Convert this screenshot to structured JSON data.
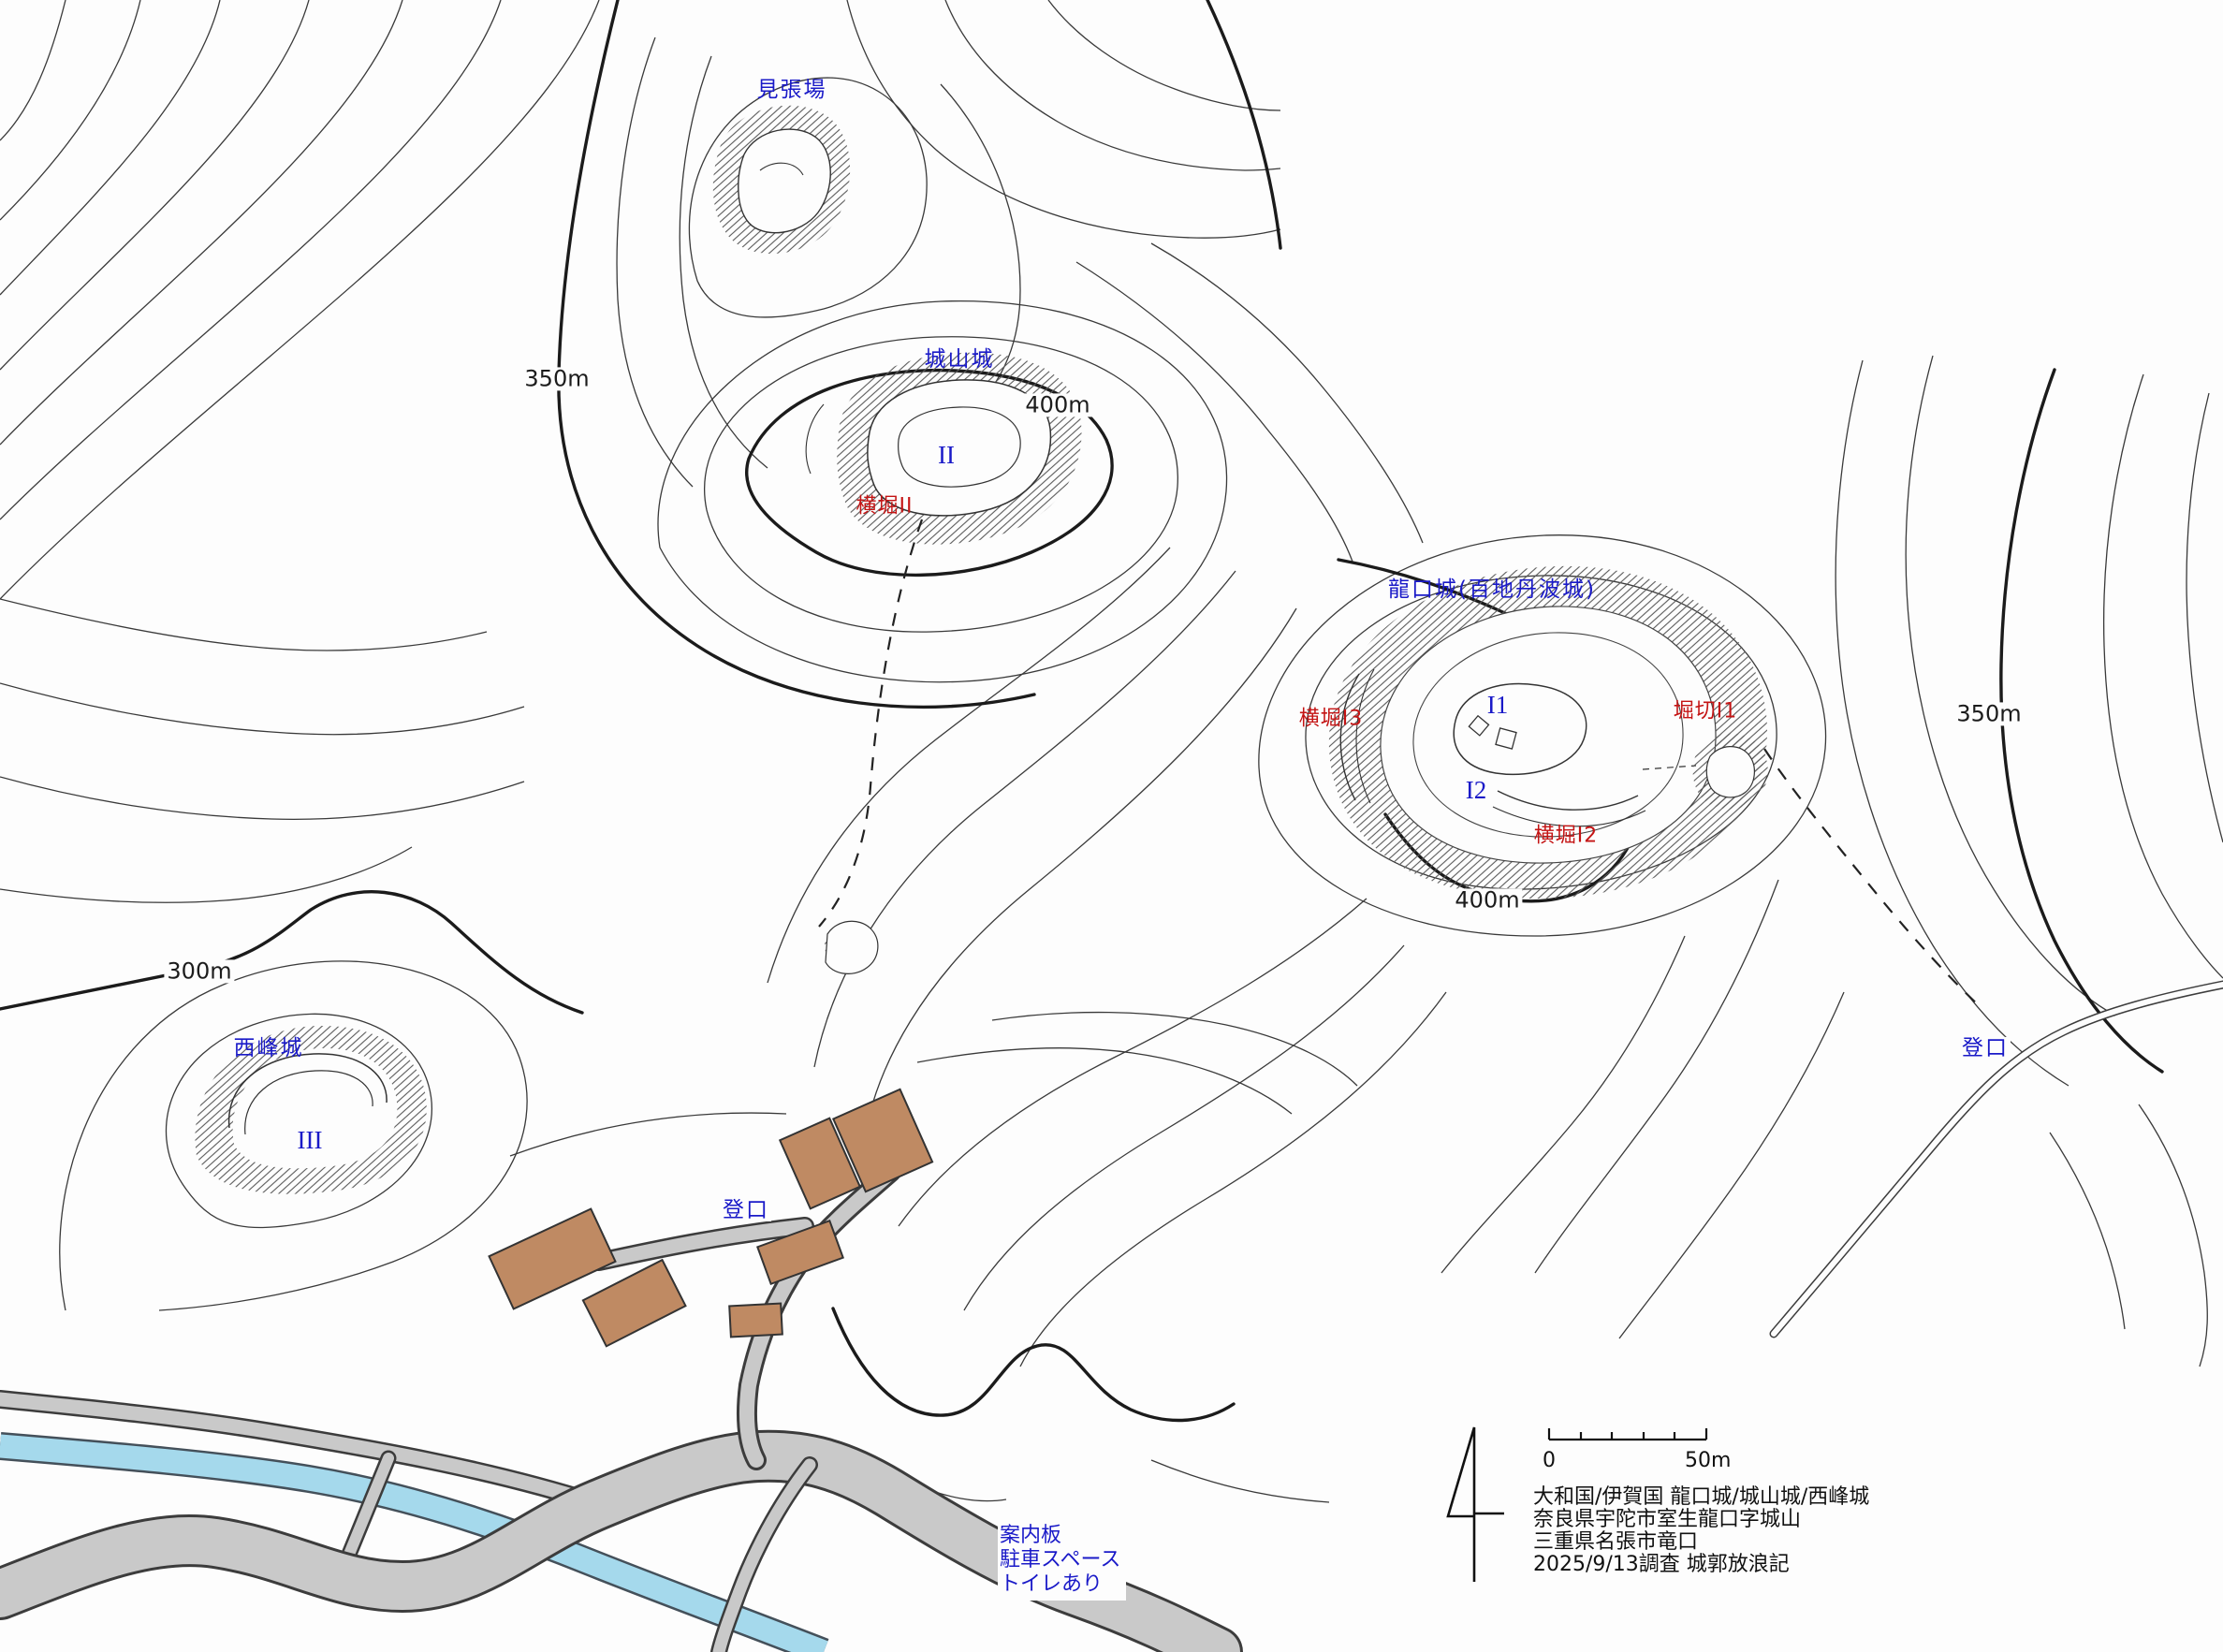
{
  "map": {
    "sites": [
      {
        "text": "見張場"
      },
      {
        "text": "城山城"
      },
      {
        "text": "龍口城(百地丹波城)"
      },
      {
        "text": "西峰城"
      }
    ],
    "red_features": [
      {
        "text": "横堀II"
      },
      {
        "text": "横堀I3"
      },
      {
        "text": "堀切I1"
      },
      {
        "text": "横堀I2"
      }
    ],
    "compartments": [
      {
        "text": "II"
      },
      {
        "text": "I1"
      },
      {
        "text": "I2"
      },
      {
        "text": "III"
      }
    ],
    "elevations": [
      {
        "text": "350m"
      },
      {
        "text": "400m"
      },
      {
        "text": "400m"
      },
      {
        "text": "300m"
      },
      {
        "text": "350m"
      }
    ],
    "entrances": [
      {
        "text": "登口"
      },
      {
        "text": "登口"
      }
    ],
    "amenity_note": [
      "案内板",
      "駐車スペース",
      "トイレあり"
    ],
    "legend": {
      "scale_start": "0",
      "scale_end": "50m",
      "info_lines": [
        "大和国/伊賀国 龍口城/城山城/西峰城",
        "奈良県宇陀市室生龍口字城山",
        "三重県名張市竜口",
        "2025/9/13調査 城郭放浪記"
      ]
    },
    "colors": {
      "label_blue": "#1a1ac8",
      "label_red": "#c41414",
      "building": "#bf8a63",
      "road": "#c9c9c9",
      "river": "#a5d9ec",
      "contour": "#2b2b2b"
    }
  }
}
